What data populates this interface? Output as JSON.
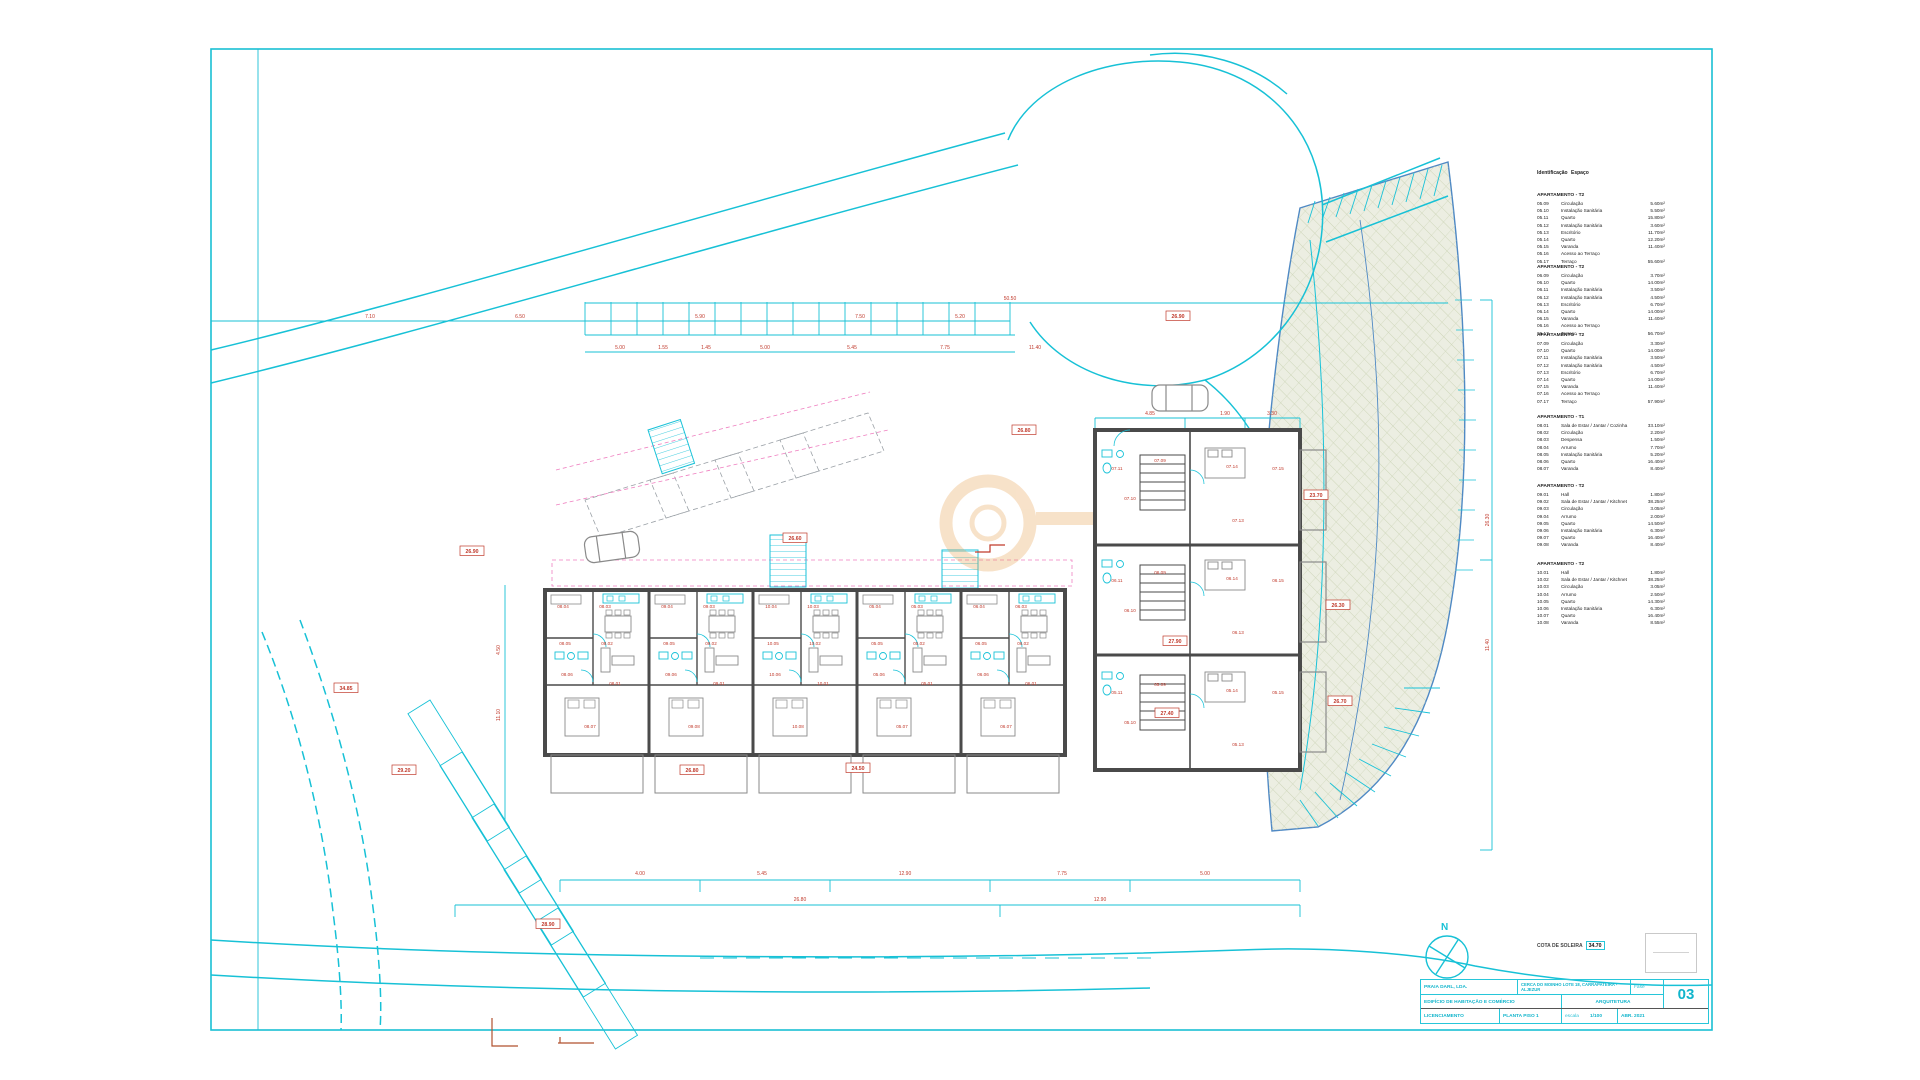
{
  "drawing": {
    "north_label": "N",
    "cota": {
      "label": "COTA DE SOLEIRA",
      "value": "34.70"
    },
    "title_block": {
      "company": "PRAIA DARL, LDA.",
      "location": "CERCA DO MOINHO LOTE 18, CARRAPATEIRA - ALJEZUR",
      "fase_label": "Fase",
      "project": "EDIFÍCIO DE HABITAÇÃO E COMÉRCIO",
      "specialty": "ARQUITETURA",
      "phase": "LICENCIAMENTO",
      "drawing_name": "PLANTA PISO 1",
      "scale_label": "escala",
      "scale_value": "1/100",
      "date": "ABR. 2021",
      "sheet_number": "03"
    },
    "legend": {
      "header": {
        "col1": "Identificação",
        "col2": "Espaço"
      },
      "blocks": [
        {
          "title": "APARTAMENTO - T2",
          "top": 23,
          "rows": [
            [
              "05.09",
              "Circulação",
              "5.60m²"
            ],
            [
              "05.10",
              "Instalação Sanitária",
              "5.50m²"
            ],
            [
              "05.11",
              "Quarto",
              "15.80m²"
            ],
            [
              "05.12",
              "Instalação Sanitária",
              "3.60m²"
            ],
            [
              "05.13",
              "Escritório",
              "11.70m²"
            ],
            [
              "05.14",
              "Quarto",
              "12.20m²"
            ],
            [
              "05.15",
              "Varanda",
              "11.40m²"
            ],
            [
              "05.16",
              "Acesso ao Terraço",
              ""
            ],
            [
              "05.17",
              "Terraço",
              "55.60m²"
            ]
          ]
        },
        {
          "title": "APARTAMENTO - T2",
          "top": 95,
          "rows": [
            [
              "06.09",
              "Circulação",
              "3.70m²"
            ],
            [
              "06.10",
              "Quarto",
              "14.00m²"
            ],
            [
              "06.11",
              "Instalação Sanitária",
              "3.50m²"
            ],
            [
              "06.12",
              "Instalação Sanitária",
              "4.50m²"
            ],
            [
              "06.13",
              "Escritório",
              "6.70m²"
            ],
            [
              "06.14",
              "Quarto",
              "14.00m²"
            ],
            [
              "06.15",
              "Varanda",
              "11.40m²"
            ],
            [
              "06.16",
              "Acesso ao Terraço",
              ""
            ],
            [
              "06.17",
              "Terraço",
              "56.70m²"
            ]
          ]
        },
        {
          "title": "APARTAMENTO - T2",
          "top": 163,
          "rows": [
            [
              "07.09",
              "Circulação",
              "3.30m²"
            ],
            [
              "07.10",
              "Quarto",
              "14.00m²"
            ],
            [
              "07.11",
              "Instalação Sanitária",
              "3.50m²"
            ],
            [
              "07.12",
              "Instalação Sanitária",
              "4.50m²"
            ],
            [
              "07.13",
              "Escritório",
              "6.70m²"
            ],
            [
              "07.14",
              "Quarto",
              "14.00m²"
            ],
            [
              "07.15",
              "Varanda",
              "11.40m²"
            ],
            [
              "07.16",
              "Acesso ao Terraço",
              ""
            ],
            [
              "07.17",
              "Terraço",
              "57.90m²"
            ]
          ]
        },
        {
          "title": "APARTAMENTO - T1",
          "top": 245,
          "rows": [
            [
              "08.01",
              "Sala de Estar / Jantar / Cozinha",
              "33.10m²"
            ],
            [
              "08.02",
              "Circulação",
              "2.20m²"
            ],
            [
              "08.03",
              "Despensa",
              "1.50m²"
            ],
            [
              "08.04",
              "Arrumo",
              "7.70m²"
            ],
            [
              "08.05",
              "Instalação Sanitária",
              "5.20m²"
            ],
            [
              "08.06",
              "Quarto",
              "16.40m²"
            ],
            [
              "08.07",
              "Varanda",
              "8.40m²"
            ]
          ]
        },
        {
          "title": "APARTAMENTO - T2",
          "top": 314,
          "rows": [
            [
              "09.01",
              "Hall",
              "1.80m²"
            ],
            [
              "09.02",
              "Sala de Estar / Jantar / Kitchnet",
              "38.25m²"
            ],
            [
              "09.03",
              "Circulação",
              "3.05m²"
            ],
            [
              "09.04",
              "Arrumo",
              "2.00m²"
            ],
            [
              "09.05",
              "Quarto",
              "14.50m²"
            ],
            [
              "09.06",
              "Instalação Sanitária",
              "6.30m²"
            ],
            [
              "09.07",
              "Quarto",
              "16.40m²"
            ],
            [
              "09.08",
              "Varanda",
              "8.40m²"
            ]
          ]
        },
        {
          "title": "APARTAMENTO - T2",
          "top": 392,
          "rows": [
            [
              "10.01",
              "Hall",
              "1.80m²"
            ],
            [
              "10.02",
              "Sala de Estar / Jantar / Kitchnet",
              "38.25m²"
            ],
            [
              "10.03",
              "Circulação",
              "3.05m²"
            ],
            [
              "10.04",
              "Arrumo",
              "2.50m²"
            ],
            [
              "10.05",
              "Quarto",
              "14.30m²"
            ],
            [
              "10.06",
              "Instalação Sanitária",
              "6.30m²"
            ],
            [
              "10.07",
              "Quarto",
              "16.40m²"
            ],
            [
              "10.08",
              "Varanda",
              "8.55m²"
            ]
          ]
        }
      ]
    },
    "plan_labels": [
      {
        "x": 563,
        "y": 608,
        "t": "08.04",
        "k": "room"
      },
      {
        "x": 605,
        "y": 608,
        "t": "08.03",
        "k": "room"
      },
      {
        "x": 565,
        "y": 645,
        "t": "08.05",
        "k": "room"
      },
      {
        "x": 607,
        "y": 645,
        "t": "08.02",
        "k": "room"
      },
      {
        "x": 567,
        "y": 676,
        "t": "08.06",
        "k": "room"
      },
      {
        "x": 615,
        "y": 685,
        "t": "08.01",
        "k": "room"
      },
      {
        "x": 590,
        "y": 728,
        "t": "08.07",
        "k": "room"
      },
      {
        "x": 667,
        "y": 608,
        "t": "09.04",
        "k": "room"
      },
      {
        "x": 709,
        "y": 608,
        "t": "09.03",
        "k": "room"
      },
      {
        "x": 669,
        "y": 645,
        "t": "09.05",
        "k": "room"
      },
      {
        "x": 711,
        "y": 645,
        "t": "09.02",
        "k": "room"
      },
      {
        "x": 671,
        "y": 676,
        "t": "09.06",
        "k": "room"
      },
      {
        "x": 719,
        "y": 685,
        "t": "09.01",
        "k": "room"
      },
      {
        "x": 694,
        "y": 728,
        "t": "09.08",
        "k": "room"
      },
      {
        "x": 771,
        "y": 608,
        "t": "10.04",
        "k": "room"
      },
      {
        "x": 813,
        "y": 608,
        "t": "10.03",
        "k": "room"
      },
      {
        "x": 773,
        "y": 645,
        "t": "10.05",
        "k": "room"
      },
      {
        "x": 815,
        "y": 645,
        "t": "10.02",
        "k": "room"
      },
      {
        "x": 775,
        "y": 676,
        "t": "10.06",
        "k": "room"
      },
      {
        "x": 823,
        "y": 685,
        "t": "10.01",
        "k": "room"
      },
      {
        "x": 798,
        "y": 728,
        "t": "10.08",
        "k": "room"
      },
      {
        "x": 875,
        "y": 608,
        "t": "05.04",
        "k": "room"
      },
      {
        "x": 917,
        "y": 608,
        "t": "05.03",
        "k": "room"
      },
      {
        "x": 877,
        "y": 645,
        "t": "05.05",
        "k": "room"
      },
      {
        "x": 919,
        "y": 645,
        "t": "05.02",
        "k": "room"
      },
      {
        "x": 879,
        "y": 676,
        "t": "05.06",
        "k": "room"
      },
      {
        "x": 927,
        "y": 685,
        "t": "05.01",
        "k": "room"
      },
      {
        "x": 902,
        "y": 728,
        "t": "05.07",
        "k": "room"
      },
      {
        "x": 979,
        "y": 608,
        "t": "06.04",
        "k": "room"
      },
      {
        "x": 1021,
        "y": 608,
        "t": "06.03",
        "k": "room"
      },
      {
        "x": 981,
        "y": 645,
        "t": "06.05",
        "k": "room"
      },
      {
        "x": 1023,
        "y": 645,
        "t": "06.02",
        "k": "room"
      },
      {
        "x": 983,
        "y": 676,
        "t": "06.06",
        "k": "room"
      },
      {
        "x": 1031,
        "y": 685,
        "t": "06.01",
        "k": "room"
      },
      {
        "x": 1006,
        "y": 728,
        "t": "06.07",
        "k": "room"
      },
      {
        "x": 1117,
        "y": 470,
        "t": "07.11",
        "k": "room"
      },
      {
        "x": 1160,
        "y": 462,
        "t": "07.09",
        "k": "room"
      },
      {
        "x": 1130,
        "y": 500,
        "t": "07.10",
        "k": "room"
      },
      {
        "x": 1232,
        "y": 468,
        "t": "07.14",
        "k": "room"
      },
      {
        "x": 1238,
        "y": 522,
        "t": "07.13",
        "k": "room"
      },
      {
        "x": 1278,
        "y": 470,
        "t": "07.15",
        "k": "room"
      },
      {
        "x": 1117,
        "y": 582,
        "t": "06.11",
        "k": "room"
      },
      {
        "x": 1160,
        "y": 574,
        "t": "06.09",
        "k": "room"
      },
      {
        "x": 1130,
        "y": 612,
        "t": "06.10",
        "k": "room"
      },
      {
        "x": 1232,
        "y": 580,
        "t": "06.14",
        "k": "room"
      },
      {
        "x": 1238,
        "y": 634,
        "t": "06.13",
        "k": "room"
      },
      {
        "x": 1278,
        "y": 582,
        "t": "06.15",
        "k": "room"
      },
      {
        "x": 1117,
        "y": 694,
        "t": "05.11",
        "k": "room"
      },
      {
        "x": 1160,
        "y": 686,
        "t": "05.09",
        "k": "room"
      },
      {
        "x": 1130,
        "y": 724,
        "t": "05.10",
        "k": "room"
      },
      {
        "x": 1232,
        "y": 692,
        "t": "05.14",
        "k": "room"
      },
      {
        "x": 1238,
        "y": 746,
        "t": "05.13",
        "k": "room"
      },
      {
        "x": 1278,
        "y": 694,
        "t": "05.15",
        "k": "room"
      },
      {
        "x": 472,
        "y": 553,
        "t": "26.90",
        "k": "elev"
      },
      {
        "x": 404,
        "y": 772,
        "t": "29.20",
        "k": "elev"
      },
      {
        "x": 548,
        "y": 926,
        "t": "28.90",
        "k": "elev"
      },
      {
        "x": 858,
        "y": 770,
        "t": "24.50",
        "k": "elev"
      },
      {
        "x": 692,
        "y": 772,
        "t": "26.80",
        "k": "elev"
      },
      {
        "x": 1024,
        "y": 432,
        "t": "26.80",
        "k": "elev"
      },
      {
        "x": 1178,
        "y": 318,
        "t": "26.90",
        "k": "elev"
      },
      {
        "x": 1316,
        "y": 497,
        "t": "23.70",
        "k": "elev"
      },
      {
        "x": 1338,
        "y": 607,
        "t": "26.30",
        "k": "elev"
      },
      {
        "x": 1340,
        "y": 703,
        "t": "26.70",
        "k": "elev"
      },
      {
        "x": 346,
        "y": 690,
        "t": "34.85",
        "k": "elev"
      },
      {
        "x": 1175,
        "y": 643,
        "t": "27.90",
        "k": "elev"
      },
      {
        "x": 1167,
        "y": 715,
        "t": "27.40",
        "k": "elev"
      },
      {
        "x": 795,
        "y": 540,
        "t": "26.60",
        "k": "elev"
      },
      {
        "x": 370,
        "y": 318,
        "t": "7.10",
        "k": "dim"
      },
      {
        "x": 520,
        "y": 318,
        "t": "6.50",
        "k": "dim"
      },
      {
        "x": 700,
        "y": 318,
        "t": "5.90",
        "k": "dim"
      },
      {
        "x": 860,
        "y": 318,
        "t": "7.50",
        "k": "dim"
      },
      {
        "x": 960,
        "y": 318,
        "t": "5.20",
        "k": "dim"
      },
      {
        "x": 1010,
        "y": 300,
        "t": "50.50",
        "k": "dim"
      },
      {
        "x": 620,
        "y": 349,
        "t": "5.00",
        "k": "dim"
      },
      {
        "x": 663,
        "y": 349,
        "t": "1.55",
        "k": "dim"
      },
      {
        "x": 706,
        "y": 349,
        "t": "1.45",
        "k": "dim"
      },
      {
        "x": 765,
        "y": 349,
        "t": "5.00",
        "k": "dim"
      },
      {
        "x": 852,
        "y": 349,
        "t": "5.45",
        "k": "dim"
      },
      {
        "x": 945,
        "y": 349,
        "t": "7.75",
        "k": "dim"
      },
      {
        "x": 1035,
        "y": 349,
        "t": "11.40",
        "k": "dim"
      },
      {
        "x": 640,
        "y": 875,
        "t": "4.00",
        "k": "dim"
      },
      {
        "x": 762,
        "y": 875,
        "t": "5.45",
        "k": "dim"
      },
      {
        "x": 905,
        "y": 875,
        "t": "12.90",
        "k": "dim"
      },
      {
        "x": 1062,
        "y": 875,
        "t": "7.75",
        "k": "dim"
      },
      {
        "x": 1205,
        "y": 875,
        "t": "5.00",
        "k": "dim"
      },
      {
        "x": 800,
        "y": 901,
        "t": "26.80",
        "k": "dim"
      },
      {
        "x": 1100,
        "y": 901,
        "t": "12.90",
        "k": "dim"
      },
      {
        "x": 1150,
        "y": 415,
        "t": "4.85",
        "k": "dim"
      },
      {
        "x": 1225,
        "y": 415,
        "t": "1.90",
        "k": "dim"
      },
      {
        "x": 1272,
        "y": 415,
        "t": "3.30",
        "k": "dim"
      },
      {
        "x": 500,
        "y": 650,
        "t": "4.50",
        "k": "dim",
        "rot": -90
      },
      {
        "x": 500,
        "y": 715,
        "t": "11.10",
        "k": "dim",
        "rot": -90
      },
      {
        "x": 1489,
        "y": 520,
        "t": "26.30",
        "k": "dim",
        "rot": -90
      },
      {
        "x": 1489,
        "y": 645,
        "t": "11.40",
        "k": "dim",
        "rot": -90
      }
    ]
  }
}
